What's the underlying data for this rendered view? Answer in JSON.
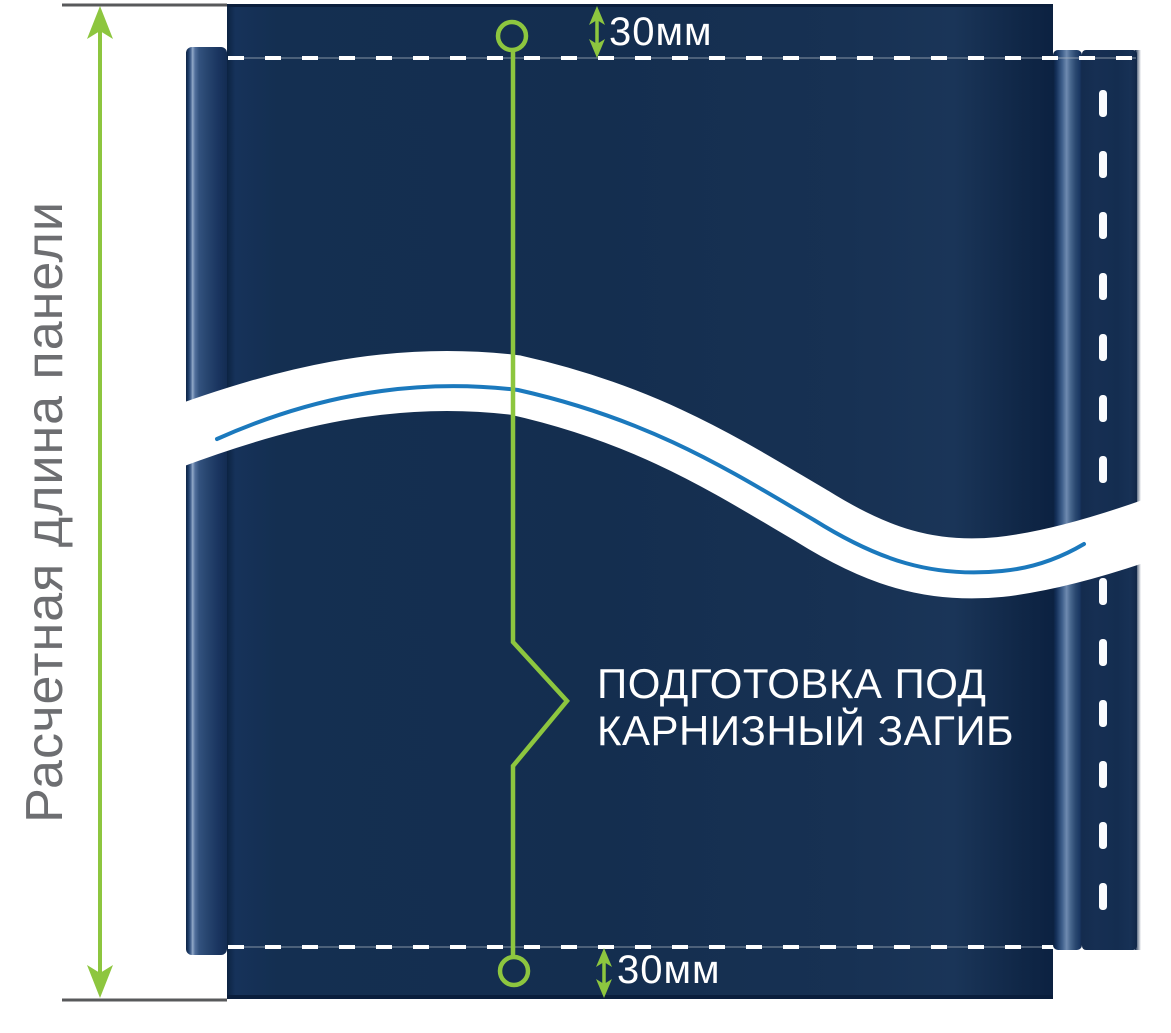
{
  "diagram": {
    "panel_length_label": "Расчетная длина панели",
    "top_offset_label": "30мм",
    "bottom_offset_label": "30мм",
    "annotation": {
      "line1": "ПОДГОТОВКА ПОД",
      "line2": "КАРНИЗНЫЙ ЗАГИБ"
    },
    "icons": {
      "dimension_arrows": "up-down-arrow",
      "offset_arrows": "double-headed-arrow",
      "markers": "circle-with-leader-line",
      "pointer": "chevron-right"
    },
    "colors": {
      "panel_navy": "#142e50",
      "accent_green": "#8dc63f",
      "break_line_blue": "#1b79bd",
      "dimension_gray": "#58595b",
      "label_gray": "#6d6e71",
      "fold_line_white": "#ffffff"
    }
  }
}
